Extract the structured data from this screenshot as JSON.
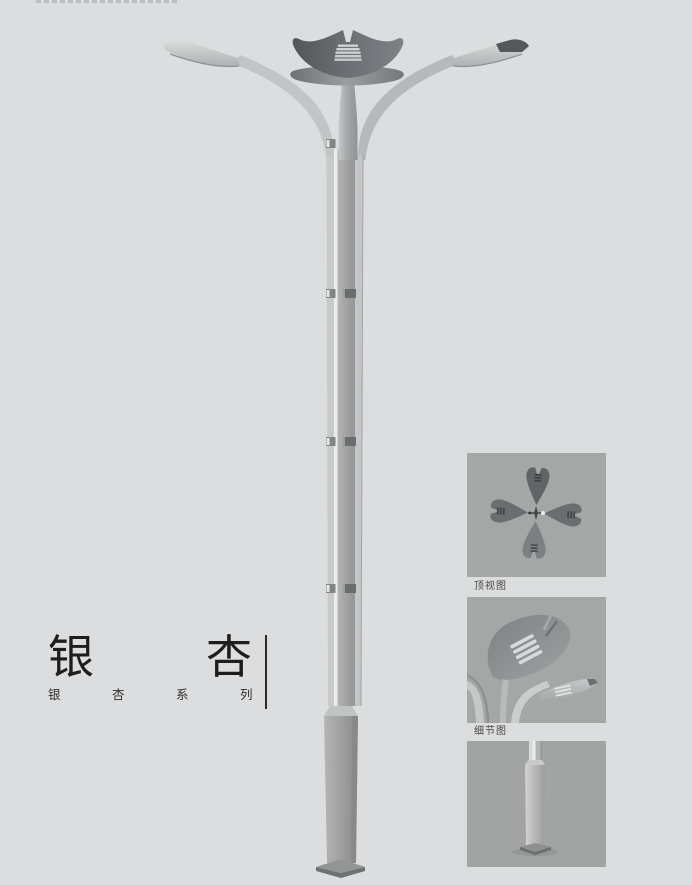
{
  "title": {
    "main": "银杏",
    "series": "银杏系列"
  },
  "panels": [
    {
      "label": "顶视图"
    },
    {
      "label": "细节图"
    },
    {
      "label": ""
    }
  ],
  "colors": {
    "page_background": "#dcddde",
    "panel_background": "#a5a6a6",
    "crown_dark": "#5a5d60",
    "pole_light": "#c6c7c8",
    "title_text": "#1d1d1d",
    "label_text": "#474747",
    "divider": "#2b2b2b"
  }
}
